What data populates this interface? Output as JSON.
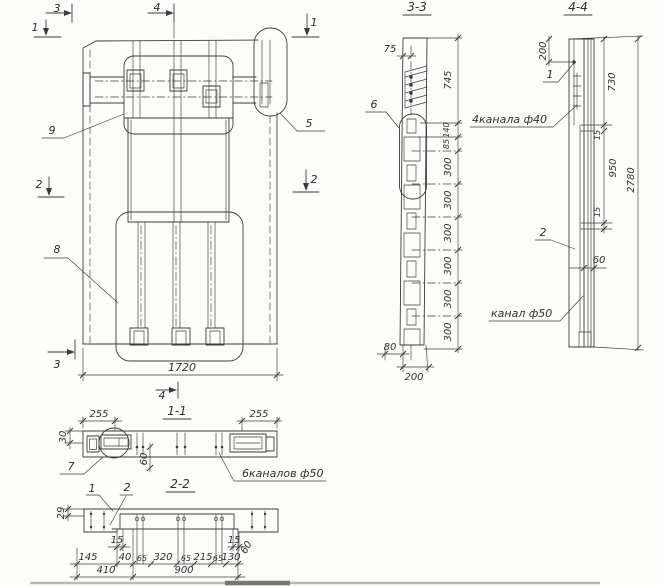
{
  "plan": {
    "markers": {
      "top3": "3",
      "top4": "4",
      "topleft1": "1",
      "topright1": "1",
      "left2": "2",
      "right2": "2",
      "bottom3": "3",
      "bottom4": "4"
    },
    "callouts": {
      "detail9": "9",
      "detail5": "5",
      "detail8": "8"
    },
    "dim_width": "1720"
  },
  "section33": {
    "title": "3-3",
    "callout_detail6": "6",
    "dim_75": "75",
    "dim_745": "745",
    "dim_140": "140",
    "dim_85": "85",
    "dims_300": [
      "300",
      "300",
      "300",
      "300",
      "300",
      "300"
    ],
    "dim_80": "80",
    "dim_200": "200"
  },
  "section44": {
    "title": "4-4",
    "callout_detail1": "1",
    "callout_detail2": "2",
    "label_channels_top": "4канала ф40",
    "label_channel_bottom": "канал ф50",
    "dim_200": "200",
    "dim_730": "730",
    "dim_15_upper": "15",
    "dim_950": "950",
    "dim_15_lower": "15",
    "dim_60": "60",
    "dim_2780": "2780"
  },
  "section11": {
    "title": "1-1",
    "callout_detail7": "7",
    "label_channels": "6каналов ф50",
    "dim_255_left": "255",
    "dim_255_right": "255",
    "dim_30": "30",
    "dim_60": "60"
  },
  "section22": {
    "title": "2-2",
    "callout_detail1": "1",
    "callout_detail2": "2",
    "dim_29": "29",
    "dim_15_left": "15",
    "dim_145": "145",
    "dim_40": "40",
    "dim_65_a": "65",
    "dim_320": "320",
    "dim_65_b": "65",
    "dim_215": "215",
    "dim_65_c": "65",
    "dim_130": "130",
    "dim_15_right": "15",
    "dim_60": "60",
    "dim_410": "410",
    "dim_900": "900"
  }
}
